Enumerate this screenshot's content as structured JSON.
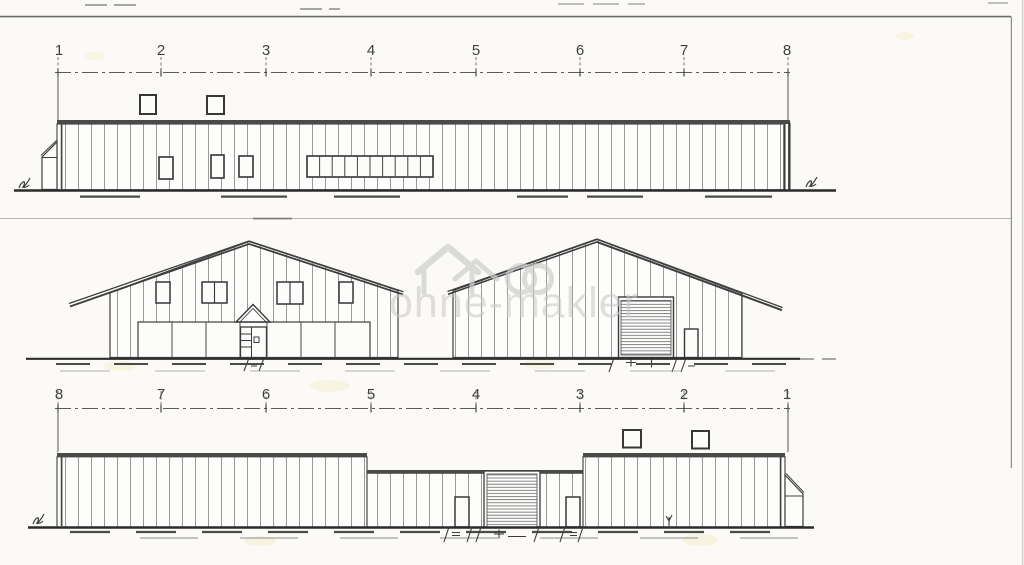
{
  "canvas": {
    "paper_color": "#fbfaf6",
    "ink_color": "#3e3e3e",
    "watermark_color": "#cbcbcb"
  },
  "grid_labels": {
    "top": [
      "1",
      "2",
      "3",
      "4",
      "5",
      "6",
      "7",
      "8"
    ],
    "bottom": [
      "8",
      "7",
      "6",
      "5",
      "4",
      "3",
      "2",
      "1"
    ]
  },
  "watermark": {
    "text": "ohne-makler",
    "color": "#c9c9c9",
    "logo_icon": "ohne-makler-house-rings-icon"
  }
}
